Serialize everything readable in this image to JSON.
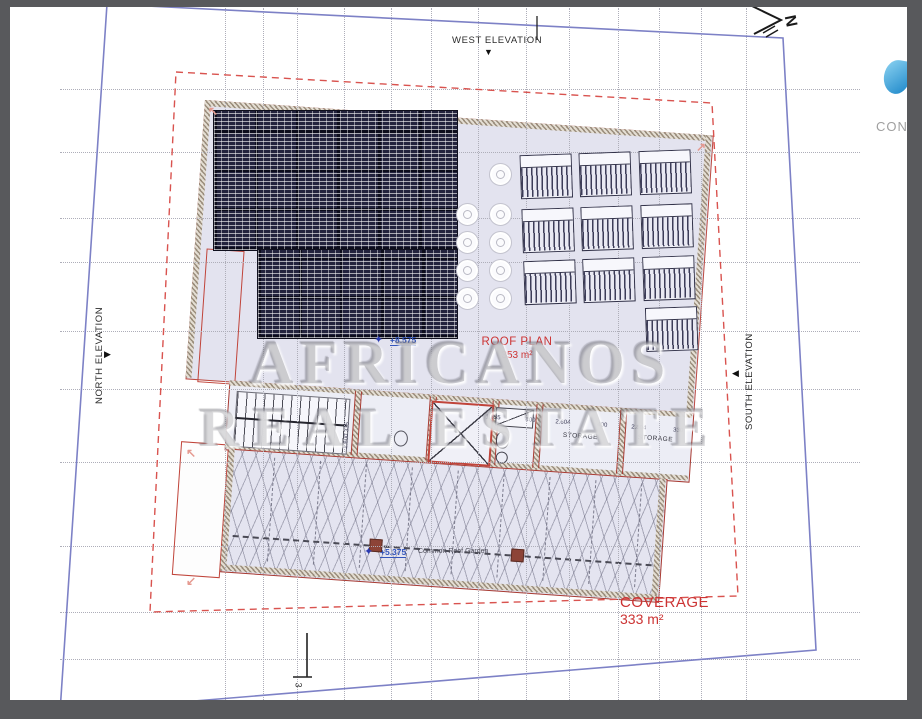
{
  "compass": {
    "north_label": "N"
  },
  "elevations": {
    "west": "WEST ELEVATION",
    "north": "NORTH ELEVATION",
    "south": "SOUTH ELEVATION",
    "west_marker": "▼",
    "north_marker": "▶",
    "south_marker": "◀"
  },
  "plan": {
    "title": "ROOF PLAN",
    "area": "353 m²",
    "coverage_label": "COVERAGE",
    "coverage_area": "333 m²",
    "level_upper": "+8.575",
    "level_garden": "+5.375",
    "garden_label": "Common Roof Garden",
    "storage_label_1": "STORAGE",
    "storage_label_2": "STORAGE",
    "dims_row": [
      "1.855",
      "400",
      "2.604",
      "400",
      "2.804",
      "330"
    ],
    "dims_vertical": "2.600  335",
    "corner_mark_label": "3"
  },
  "watermark": {
    "line1": "AFRICANOS",
    "line2": "REAL ESTATE"
  },
  "logo": {
    "partial_text": "CON"
  },
  "colors": {
    "boundary_blue": "#7d81c6",
    "setback_red": "#d9534f",
    "outline_red": "#b5433b",
    "text_red": "#cc3333",
    "level_blue": "#3355bb",
    "slab_fill": "#e3e3ef",
    "panel_dark": "#23233d",
    "frame_gray": "#58595c",
    "logo_drop": "#1a85c8"
  }
}
